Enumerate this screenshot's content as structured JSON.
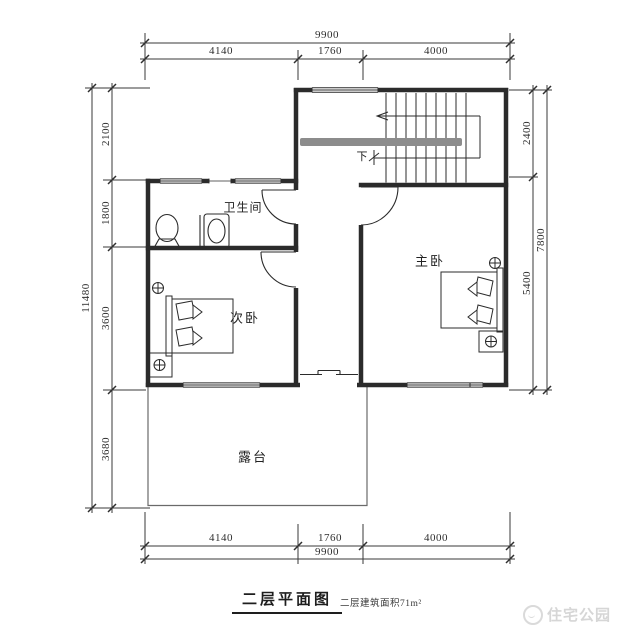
{
  "rooms": {
    "bathroom": "卫生间",
    "secondary_bedroom": "次卧",
    "master_bedroom": "主卧",
    "terrace": "露台"
  },
  "stairs": {
    "direction_label": "下"
  },
  "dims": {
    "top_total": "9900",
    "top_seg1": "4140",
    "top_seg2": "1760",
    "top_seg3": "4000",
    "bottom_seg1": "4140",
    "bottom_seg2": "1760",
    "bottom_seg3": "4000",
    "bottom_total": "9900",
    "left_total": "11480",
    "left_seg1": "2100",
    "left_seg2": "1800",
    "left_seg3": "3600",
    "left_seg4": "3680",
    "right_seg1": "2400",
    "right_seg2": "5400",
    "right_total": "7800"
  },
  "title": {
    "main": "二层平面图",
    "area_note": "二层建筑面积71m²"
  },
  "watermark": {
    "brand": "住宅公园"
  },
  "colors": {
    "wall": "#2b2b2b",
    "dim_line": "#3a3a3a",
    "handrail": "#8c8c8c",
    "watermark": "#d6d6d6"
  }
}
